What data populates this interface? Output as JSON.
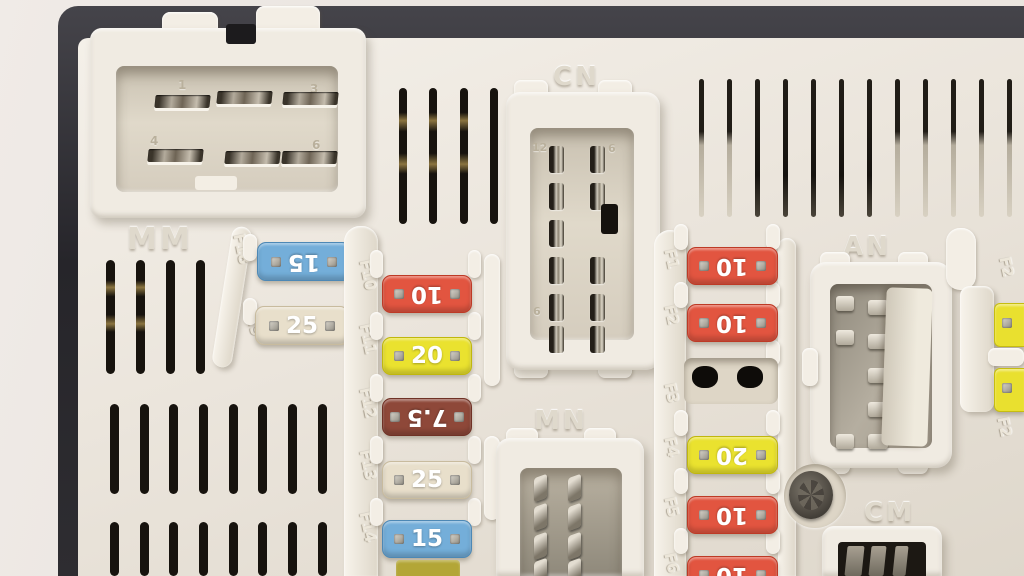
{
  "scene": {
    "type": "photograph",
    "subject": "automotive fuse box (body control module) close-up",
    "palette": {
      "wall": "#ece6e0",
      "housing_black": "#2c2b2e",
      "plastic_body": "#ece6dc",
      "fuse_blue": "#74aed9",
      "fuse_tan": "#e8dfcb",
      "fuse_red": "#e25540",
      "fuse_yellow": "#eae22f",
      "fuse_brown": "#8e4839"
    }
  },
  "connectors": {
    "mm": {
      "label": "MM",
      "pins": [
        "1",
        "3",
        "4",
        "6"
      ]
    },
    "cn": {
      "label": "CN",
      "pin_numbers": [
        "12",
        "6",
        "6"
      ]
    },
    "mn": {
      "label": "MN"
    },
    "an": {
      "label": "AN"
    },
    "cm": {
      "label": "CM"
    }
  },
  "fuse_banks": {
    "left": {
      "rail_labels": [
        "F18",
        "F19"
      ],
      "fuses": [
        {
          "id": "F18",
          "amp": "15",
          "color": "#74aed9",
          "flipped": true
        },
        {
          "id": "F19",
          "amp": "25",
          "color": "#e8dfcb",
          "flipped": false
        }
      ]
    },
    "middle": {
      "rail_labels": [
        "F10",
        "F11",
        "F12",
        "F13",
        "F14"
      ],
      "fuses": [
        {
          "id": "F10",
          "amp": "10",
          "color": "#e25540",
          "flipped": true
        },
        {
          "id": "F11",
          "amp": "20",
          "color": "#eae22f",
          "flipped": false
        },
        {
          "id": "F12",
          "amp": "7.5",
          "color": "#8e4839",
          "flipped": true
        },
        {
          "id": "F13",
          "amp": "25",
          "color": "#e8dfcb",
          "flipped": false
        },
        {
          "id": "F14",
          "amp": "15",
          "color": "#74aed9",
          "flipped": false
        }
      ]
    },
    "right": {
      "rail_labels": [
        "F1",
        "F2",
        "F3",
        "F4",
        "F5",
        "F6"
      ],
      "fuses": [
        {
          "id": "F1",
          "amp": "10",
          "color": "#e25540",
          "flipped": true
        },
        {
          "id": "F2",
          "amp": "10",
          "color": "#e25540",
          "flipped": true
        },
        {
          "id": "F3",
          "amp": "",
          "empty": true
        },
        {
          "id": "F4",
          "amp": "20",
          "color": "#eae22f",
          "flipped": true
        },
        {
          "id": "F5",
          "amp": "10",
          "color": "#e25540",
          "flipped": true
        },
        {
          "id": "F6",
          "amp": "10",
          "color": "#e25540",
          "flipped": true
        }
      ]
    },
    "edge": {
      "rail_labels": [
        "F2",
        "F2"
      ],
      "fuses": [
        {
          "amp": "",
          "color": "#e9e02f"
        },
        {
          "amp": "",
          "color": "#e9e02f"
        }
      ]
    }
  }
}
